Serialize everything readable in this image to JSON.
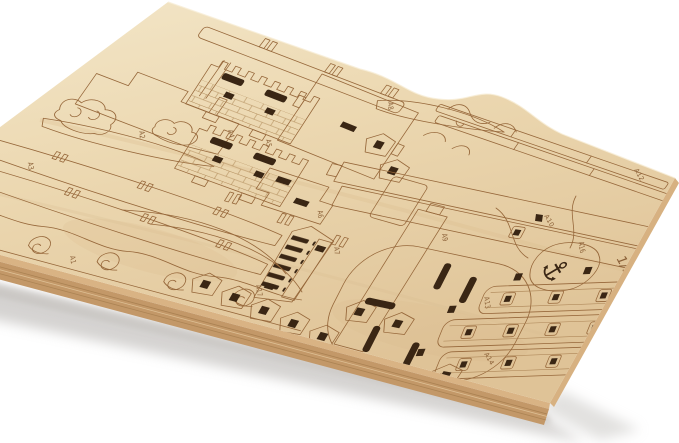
{
  "photo": {
    "subject": "Stack of laser-cut plywood sheets with model-kit parts on a white background",
    "background_color": "#ffffff"
  },
  "wood": {
    "face_color": "#ecd8b2",
    "edge_color": "#c39868",
    "engrave_color": "#96673a",
    "hole_color": "#3a2614",
    "shadow_color": "#c7c5c2"
  },
  "sheet": {
    "sheet_number": "1/3",
    "part_count_labels": 17
  },
  "labels": {
    "A1": "A1",
    "A2": "A2",
    "A3": "A3",
    "A4": "A4",
    "A5": "A5",
    "A6": "A6",
    "A7": "A7",
    "A8": "A8",
    "A9": "A9",
    "A10": "A10",
    "A11": "A11",
    "A12": "A12",
    "A13": "A13",
    "A14": "A14",
    "A15": "A15",
    "A16": "A16",
    "A17": "A17",
    "sheet_no": "1/3"
  },
  "parts": [
    {
      "label": "A1",
      "kind": "wave-border strip"
    },
    {
      "label": "A2",
      "kind": "cloud and plank piece"
    },
    {
      "label": "A3",
      "kind": "long hull planks"
    },
    {
      "label": "A4",
      "kind": "castle wall with battlements"
    },
    {
      "label": "A5",
      "kind": "large brick panel"
    },
    {
      "label": "A6",
      "kind": "stepped brick piece"
    },
    {
      "label": "A7",
      "kind": "slatted ladder piece"
    },
    {
      "label": "A8",
      "kind": "curved bow plank"
    },
    {
      "label": "A9",
      "kind": "double-row hole strip"
    },
    {
      "label": "A10",
      "kind": "long deck hole strip"
    },
    {
      "label": "A11",
      "kind": "thin edge strip"
    },
    {
      "label": "A12",
      "kind": "thin edge strip"
    },
    {
      "label": "A13",
      "kind": "oval deck panel with slots"
    },
    {
      "label": "A14",
      "kind": "curved strip with framed holes"
    },
    {
      "label": "A15",
      "kind": "small house-shaped piece"
    },
    {
      "label": "A16",
      "kind": "anchor cutout piece"
    },
    {
      "label": "A17",
      "kind": "small house-shaped pieces"
    }
  ]
}
